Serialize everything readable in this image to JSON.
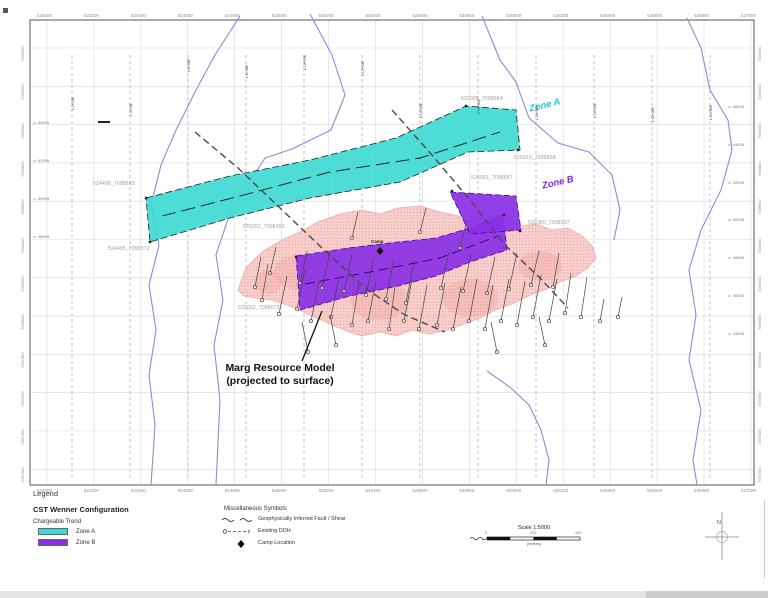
{
  "map": {
    "frame": {
      "x": 30,
      "y": 20,
      "w": 724,
      "h": 465
    },
    "easting_labels": [
      "524000",
      "524200",
      "524400",
      "524600",
      "524800",
      "525000",
      "525200",
      "525400",
      "525600",
      "525800",
      "526000",
      "526200",
      "526400",
      "526600",
      "526800",
      "527000"
    ],
    "northing_labels": [
      "7099400",
      "7099200",
      "7099000",
      "7098800",
      "7098600",
      "7098400",
      "7098200",
      "7098000",
      "7097800",
      "7097600",
      "7097400",
      "7097200"
    ],
    "survey_lines": [
      {
        "x": 72,
        "label": "L 2+00E",
        "label_y": 88
      },
      {
        "x": 130,
        "label": "L 4+00E",
        "label_y": 94
      },
      {
        "x": 188,
        "label": "L 6+00E",
        "label_y": 50
      },
      {
        "x": 246,
        "label": "L 8+00E",
        "label_y": 56
      },
      {
        "x": 304,
        "label": "L 10+00E",
        "label_y": 48
      },
      {
        "x": 362,
        "label": "L 12+00E",
        "label_y": 54
      },
      {
        "x": 420,
        "label": "L 14+00E",
        "label_y": 96
      },
      {
        "x": 478,
        "label": "L 16+00E",
        "label_y": 92
      },
      {
        "x": 536,
        "label": "L 18+00E",
        "label_y": 98
      },
      {
        "x": 594,
        "label": "L 20+00E",
        "label_y": 96
      },
      {
        "x": 652,
        "label": "L 22+00E",
        "label_y": 100
      },
      {
        "x": 710,
        "label": "L 24+00E",
        "label_y": 98
      }
    ],
    "inner_right_ticks": [
      {
        "label": "6600N",
        "y": 105
      },
      {
        "label": "6400N",
        "y": 143
      },
      {
        "label": "6200N",
        "y": 181
      },
      {
        "label": "6000N",
        "y": 218
      },
      {
        "label": "5800N",
        "y": 256
      },
      {
        "label": "5600N",
        "y": 294
      },
      {
        "label": "5400N",
        "y": 332
      }
    ],
    "inner_left_ticks": [
      {
        "label": "6400N",
        "y": 121
      },
      {
        "label": "6200N",
        "y": 159
      },
      {
        "label": "6000N",
        "y": 197
      },
      {
        "label": "5800N",
        "y": 235
      }
    ],
    "collar_labels": [
      {
        "text": "524408_7098593",
        "x": 93,
        "y": 181
      },
      {
        "text": "524495_7098372",
        "x": 108,
        "y": 246
      },
      {
        "text": "525052_7098352",
        "x": 243,
        "y": 224
      },
      {
        "text": "525052_7098075",
        "x": 238,
        "y": 305
      },
      {
        "text": "526008_7099064",
        "x": 461,
        "y": 96
      },
      {
        "text": "526010_7098858",
        "x": 514,
        "y": 155
      },
      {
        "text": "526063_7098667",
        "x": 471,
        "y": 175
      },
      {
        "text": "526080_7098507",
        "x": 528,
        "y": 220
      }
    ],
    "zone_a": {
      "label": "Zone A",
      "fill": "#3fd9d2",
      "polygon": [
        146,
        198,
        230,
        176,
        310,
        160,
        396,
        138,
        466,
        106,
        516,
        110,
        520,
        150,
        468,
        152,
        400,
        182,
        310,
        198,
        230,
        218,
        150,
        242
      ],
      "centerline": [
        162,
        216,
        240,
        196,
        330,
        172,
        420,
        158,
        500,
        132
      ]
    },
    "zone_b": {
      "label": "Zone B",
      "fill": "#8a2fe6",
      "polygon_main": [
        296,
        256,
        348,
        248,
        398,
        242,
        436,
        238,
        470,
        228,
        503,
        214,
        507,
        250,
        470,
        262,
        436,
        276,
        398,
        286,
        350,
        296,
        300,
        310
      ],
      "polygon_upper": [
        450,
        192,
        516,
        196,
        521,
        230,
        470,
        234
      ],
      "centerline": [
        305,
        284,
        370,
        272,
        440,
        258,
        498,
        236
      ]
    },
    "resource": {
      "fill": "#f7c8c4",
      "dot": "#e98e8b",
      "polygon": [
        238,
        290,
        246,
        268,
        262,
        252,
        282,
        240,
        300,
        232,
        318,
        222,
        340,
        214,
        362,
        210,
        380,
        214,
        398,
        208,
        420,
        206,
        440,
        212,
        458,
        216,
        470,
        222,
        482,
        218,
        494,
        224,
        508,
        220,
        520,
        226,
        536,
        224,
        552,
        230,
        568,
        228,
        582,
        236,
        592,
        246,
        596,
        258,
        588,
        268,
        576,
        276,
        560,
        282,
        544,
        290,
        528,
        296,
        512,
        304,
        496,
        310,
        480,
        318,
        464,
        324,
        448,
        330,
        430,
        334,
        412,
        330,
        396,
        336,
        380,
        332,
        362,
        336,
        344,
        330,
        326,
        322,
        308,
        314,
        290,
        306,
        272,
        300,
        256,
        298,
        244,
        296
      ]
    },
    "faults": [
      [
        392,
        110,
        432,
        155,
        470,
        200,
        505,
        245,
        540,
        278,
        568,
        308
      ],
      [
        195,
        132,
        238,
        168,
        280,
        208,
        322,
        248,
        365,
        288,
        405,
        315,
        445,
        332
      ]
    ],
    "creeks": [
      [
        240,
        16,
        215,
        55,
        196,
        90,
        176,
        130,
        161,
        165,
        151,
        205,
        159,
        245,
        149,
        285,
        156,
        330,
        149,
        375,
        155,
        425,
        151,
        485
      ],
      [
        310,
        14,
        332,
        55,
        345,
        95,
        331,
        130,
        292,
        149,
        265,
        158,
        231,
        210,
        216,
        255,
        223,
        300,
        214,
        345,
        220,
        400,
        216,
        485
      ],
      [
        482,
        16,
        500,
        60,
        516,
        82,
        529,
        118,
        558,
        143,
        589,
        152,
        612,
        175,
        620,
        210,
        614,
        240
      ],
      [
        687,
        18,
        701,
        48,
        710,
        90,
        728,
        120,
        732,
        150,
        721,
        190,
        701,
        230,
        689,
        270,
        696,
        315,
        689,
        360,
        701,
        410,
        693,
        460,
        697,
        485
      ],
      [
        487,
        371,
        511,
        388,
        529,
        405,
        541,
        430,
        549,
        460,
        546,
        485
      ]
    ],
    "drillholes": [
      [
        262,
        300,
        268,
        264
      ],
      [
        279,
        314,
        287,
        276
      ],
      [
        297,
        309,
        305,
        269
      ],
      [
        311,
        321,
        319,
        281
      ],
      [
        331,
        317,
        339,
        277
      ],
      [
        352,
        325,
        359,
        283
      ],
      [
        368,
        321,
        376,
        281
      ],
      [
        389,
        329,
        395,
        287
      ],
      [
        404,
        321,
        412,
        279
      ],
      [
        419,
        329,
        427,
        285
      ],
      [
        300,
        283,
        307,
        251
      ],
      [
        322,
        288,
        330,
        252
      ],
      [
        344,
        291,
        352,
        255
      ],
      [
        366,
        295,
        374,
        257
      ],
      [
        386,
        299,
        394,
        259
      ],
      [
        406,
        303,
        414,
        261
      ],
      [
        255,
        287,
        261,
        257
      ],
      [
        270,
        273,
        276,
        247
      ],
      [
        336,
        345,
        330,
        315
      ],
      [
        308,
        352,
        302,
        322
      ],
      [
        437,
        325,
        445,
        283
      ],
      [
        453,
        329,
        461,
        287
      ],
      [
        469,
        321,
        477,
        279
      ],
      [
        485,
        329,
        493,
        285
      ],
      [
        501,
        321,
        509,
        279
      ],
      [
        517,
        325,
        525,
        281
      ],
      [
        533,
        317,
        541,
        275
      ],
      [
        549,
        321,
        557,
        279
      ],
      [
        565,
        313,
        571,
        273
      ],
      [
        581,
        317,
        587,
        277
      ],
      [
        441,
        288,
        449,
        252
      ],
      [
        463,
        291,
        471,
        255
      ],
      [
        487,
        293,
        495,
        257
      ],
      [
        509,
        289,
        517,
        253
      ],
      [
        531,
        285,
        539,
        251
      ],
      [
        553,
        287,
        559,
        253
      ],
      [
        600,
        321,
        604,
        299
      ],
      [
        618,
        317,
        622,
        297
      ],
      [
        497,
        352,
        491,
        322
      ],
      [
        545,
        345,
        539,
        317
      ],
      [
        352,
        238,
        358,
        212
      ],
      [
        420,
        232,
        426,
        208
      ],
      [
        460,
        248,
        466,
        224
      ]
    ],
    "camp": {
      "label": "Camp",
      "x": 380,
      "y": 251
    }
  },
  "annotation": {
    "line1": "Marg Resource Model",
    "line2": "(projected to surface)",
    "leader": [
      302,
      361,
      322,
      311
    ]
  },
  "legend": {
    "title": "Legend",
    "config_title": "CST Wenner Configuration",
    "subtitle": "Chargeable Trend",
    "zone_a_label": "Zone A",
    "zone_b_label": "Zone B",
    "zone_a_color": "#3fd9d2",
    "zone_b_color": "#8a2fe6"
  },
  "misc_symbols": {
    "title": "Miscellaneous Symbols",
    "fault_label": "Geophysically Inferred Fault / Shear",
    "ddh_label": "Existing DDH",
    "camp_label": "Camp Location"
  },
  "scale": {
    "title": "Scale 1:5000",
    "units": "(metres)",
    "tick_start": "0",
    "tick_mid": "200",
    "tick_end": "400"
  },
  "north": {
    "letter": "N"
  }
}
